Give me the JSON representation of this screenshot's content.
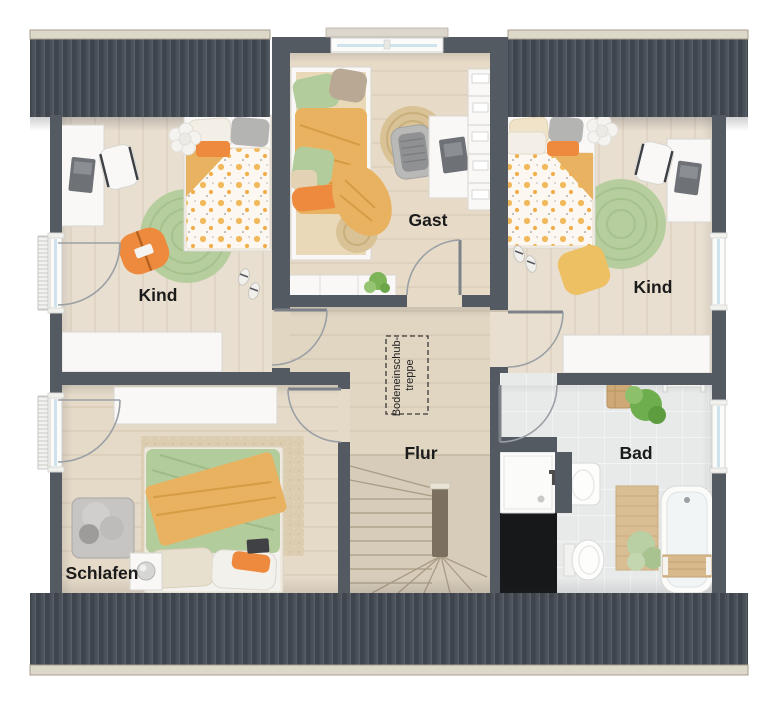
{
  "rooms": {
    "kind_left": {
      "label": "Kind"
    },
    "gast": {
      "label": "Gast"
    },
    "kind_right": {
      "label": "Kind"
    },
    "schlafen": {
      "label": "Schlafen"
    },
    "flur": {
      "label": "Flur"
    },
    "bad": {
      "label": "Bad"
    }
  },
  "annotations": {
    "attic_hatch": {
      "line1": "Bodeneinschub-",
      "line2": "treppe"
    }
  },
  "colors": {
    "wall": "#545a62",
    "roof": "#495058",
    "roof_rib": "#3e454d",
    "roof_hi": "#575e67",
    "gutter": "#ded8ca",
    "gutter_edge": "#a59e8e",
    "floor_wood": "#e9dfd0",
    "floor_gast": "#e7dbc8",
    "floor_hall": "#e1d6c2",
    "floor_schlafen": "#e5dac8",
    "floor_stairs": "#d7ccba",
    "tile": "#e8eaea",
    "tile_grout": "#f5f6f7",
    "furniture_white": "#f9f8f6",
    "furniture_edge": "#d8d6d1",
    "accent_orange": "#ee8a3d",
    "accent_mustard": "#e8b261",
    "accent_green": "#b6cd9e",
    "textile_green": "#b3cc9c",
    "jute": "#d8c296",
    "textile_gray": "#b4b4b2",
    "laptop_gray": "#6e7277",
    "void_black": "#17181a",
    "glass": "#cfe3ef",
    "stair_stringer": "#7b7060"
  }
}
